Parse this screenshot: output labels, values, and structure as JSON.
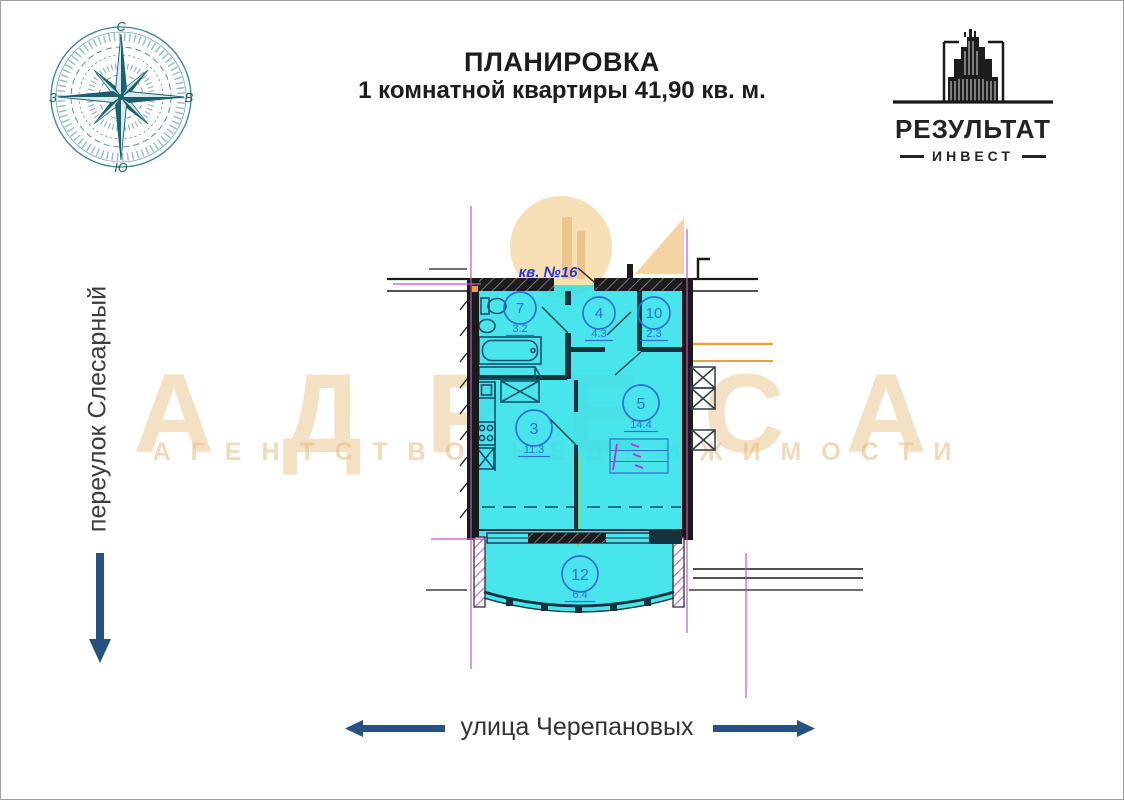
{
  "header": {
    "title_line1": "ПЛАНИРОВКА",
    "title_line2": "1 комнатной квартиры 41,90 кв. м."
  },
  "logo": {
    "name": "РЕЗУЛЬТАТ",
    "subtitle": "ИНВЕСТ"
  },
  "compass": {
    "north": "С",
    "east": "В",
    "south": "Ю",
    "west": "З"
  },
  "streets": {
    "left": "переулок Слесарный",
    "bottom": "улица Черепановых"
  },
  "watermark": {
    "title": "АДРЕСА",
    "subtitle": "АГЕНТСТВО НЕДВИЖИМОСТИ"
  },
  "plan": {
    "apartment_label": "кв. №16",
    "total_area_label": "41,90 кв. м.",
    "rooms": [
      {
        "number": "7",
        "area": "3.2"
      },
      {
        "number": "4",
        "area": "4.3"
      },
      {
        "number": "10",
        "area": "2.3"
      },
      {
        "number": "3",
        "area": "11.3"
      },
      {
        "number": "5",
        "area": "14.4"
      },
      {
        "number": "12",
        "area": "6.4"
      }
    ]
  },
  "colors": {
    "apartment_fill": "#2DE1EA",
    "axis_magenta": "#CB4FCB",
    "arrow_navy": "#27527F",
    "watermark_tan": "#EAC287",
    "plan_blue": "#2E6FD0",
    "compass_teal": "#1D5F6E",
    "orange_line": "#E8A23C"
  }
}
